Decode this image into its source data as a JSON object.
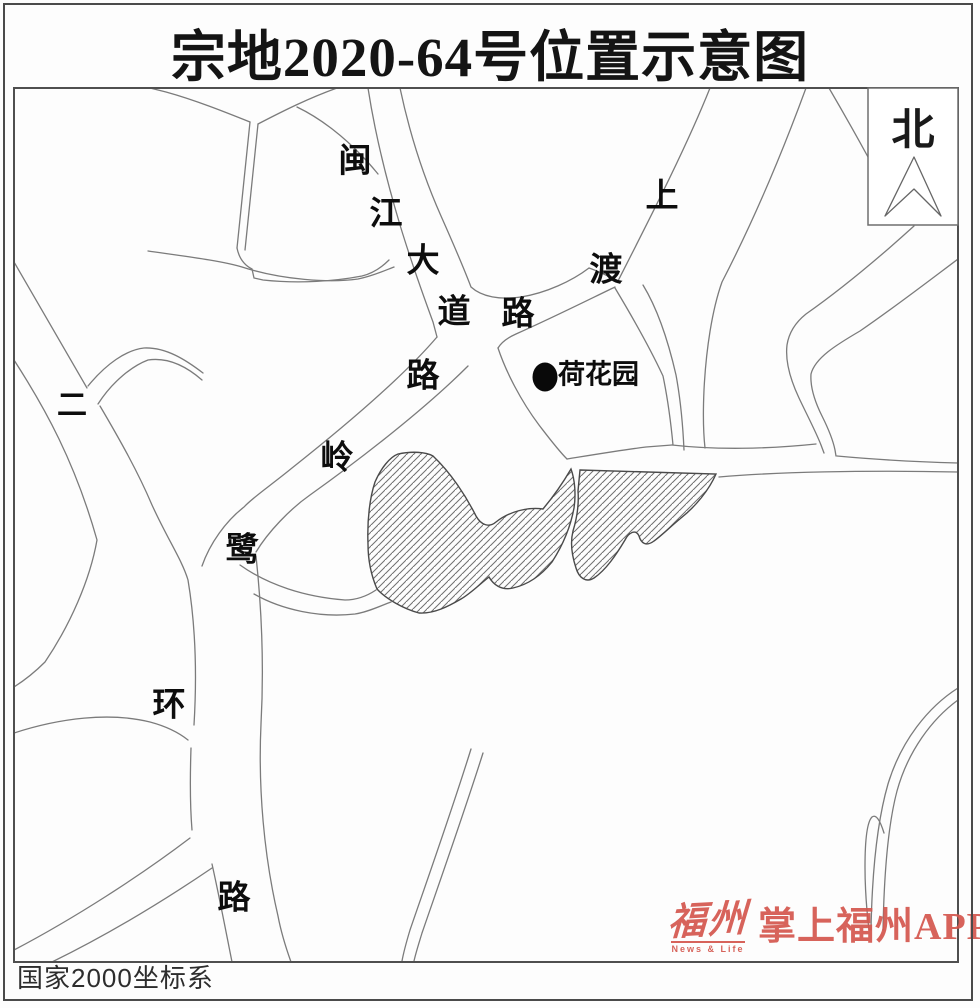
{
  "title": "宗地2020-64号位置示意图",
  "map": {
    "north_indicator": "北",
    "poi": {
      "label": "荷花园"
    },
    "road_labels": [
      {
        "road": "minjiang-avenue",
        "char": "闽",
        "x": 355,
        "y": 160
      },
      {
        "road": "minjiang-avenue",
        "char": "江",
        "x": 386,
        "y": 213
      },
      {
        "road": "minjiang-avenue",
        "char": "大",
        "x": 423,
        "y": 260
      },
      {
        "road": "minjiang-avenue",
        "char": "道",
        "x": 454,
        "y": 311
      },
      {
        "road": "shangdu-road",
        "char": "上",
        "x": 662,
        "y": 195
      },
      {
        "road": "shangdu-road",
        "char": "渡",
        "x": 606,
        "y": 269
      },
      {
        "road": "shangdu-road",
        "char": "路",
        "x": 518,
        "y": 313
      },
      {
        "road": "luling-road",
        "char": "路",
        "x": 423,
        "y": 375
      },
      {
        "road": "luling-road",
        "char": "岭",
        "x": 337,
        "y": 457
      },
      {
        "road": "luling-road",
        "char": "鹭",
        "x": 242,
        "y": 549
      },
      {
        "road": "second-ring-road",
        "char": "二",
        "x": 72,
        "y": 406
      },
      {
        "road": "second-ring-road",
        "char": "环",
        "x": 169,
        "y": 704
      },
      {
        "road": "second-ring-road",
        "char": "路",
        "x": 234,
        "y": 897
      }
    ],
    "footnote": "国家2000坐标系"
  },
  "watermark": {
    "brand": "福州",
    "brand_sub": "News & Life",
    "app": "掌上福州APP"
  },
  "colors": {
    "road_line": "#7b7b7b",
    "parcel_outline": "#4a4a4a",
    "hatch_line": "#6f6f6f",
    "watermark_red": "#d4574e",
    "title_ink": "#141414"
  }
}
